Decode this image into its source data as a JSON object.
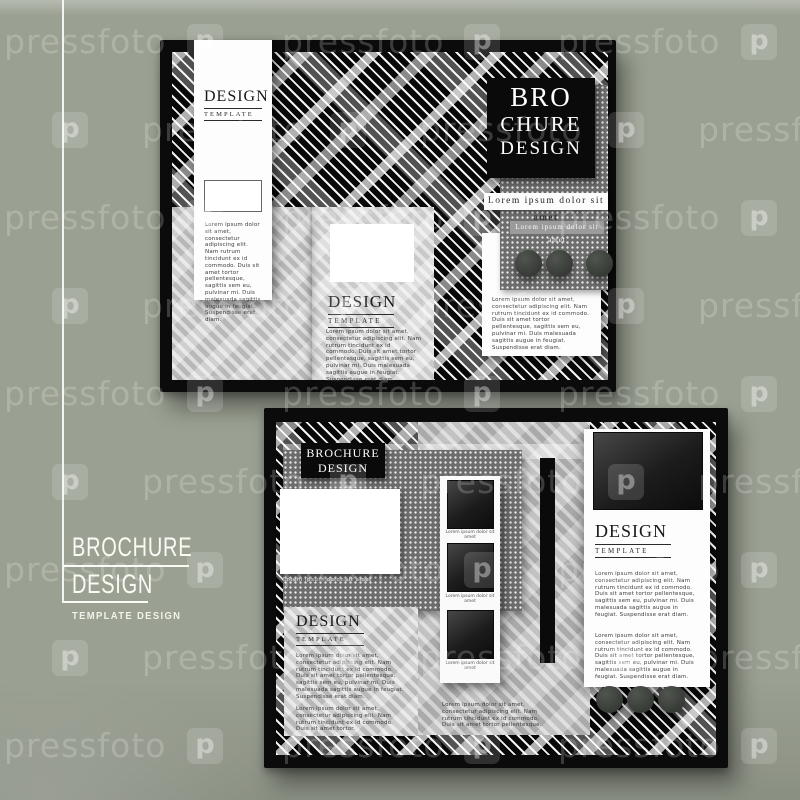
{
  "watermark": {
    "text": "pressfoto",
    "logo_letter": "p"
  },
  "brand": {
    "line1": "BROCHURE",
    "line2": "DESIGN",
    "tagline": "TEMPLATE DESIGN"
  },
  "lorem": {
    "long": "Lorem ipsum dolor sit amet, consectetur adipiscing elit. Nam rutrum tincidunt ex id commodo. Duis sit amet tortor pellentesque, sagittis sem eu, pulvinar mi. Duis malesuada sagittis augue in feugiat. Suspendisse erat diam.",
    "medium": "Lorem ipsum dolor sit amet, consectetur adipiscing elit. Nam rutrum tincidunt ex id commodo. Duis sit amet tortor pellentesque.",
    "short": "Lorem ipsum dolor sit amet, consectetur adipiscing elit. Nam rutrum tincidunt ex id commodo. Duis sit amet tortor."
  },
  "top_brochure": {
    "banner": {
      "title": "DESIGN",
      "subtitle": "TEMPLATE"
    },
    "center_panel": {
      "title": "DESIGN",
      "subtitle": "TEMPLATE"
    },
    "cover": {
      "line1": "BRO",
      "line2": "CHURE",
      "line3": "DESIGN"
    },
    "strip_white": "Lorem ipsum dolor sit amet",
    "strip_gray": "Lorem ipsum dolor sit amet"
  },
  "bottom_brochure": {
    "label": {
      "line1": "BROCHURE",
      "line2": "DESIGN"
    },
    "photo_caption": "Lorem ipsum dolor sit amet",
    "film_captions": [
      "Lorem ipsum dolor sit amet",
      "Lorem ipsum dolor sit amet",
      "Lorem ipsum dolor sit amet"
    ],
    "left_panel": {
      "title": "DESIGN",
      "subtitle": "TEMPLATE"
    },
    "right_panel": {
      "title": "DESIGN",
      "subtitle": "TEMPLATE"
    }
  },
  "colors": {
    "background": "#9aa092",
    "frame_black": "#0b0b0b",
    "plaid_base": "#141414",
    "dotted_panel": "#6d6d6d",
    "panel_light": "#c8c8c8",
    "panel_lighter": "#d5d5d5",
    "card_white": "#fdfdfd",
    "circle": "#3a3e3a",
    "brand_text": "#fbfbf5",
    "watermark": "rgba(255,255,255,0.20)"
  }
}
